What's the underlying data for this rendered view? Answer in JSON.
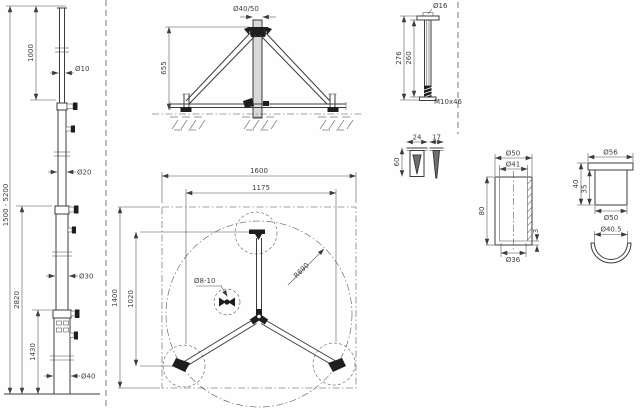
{
  "colors": {
    "line": "#3c3c3c",
    "dark_fill": "#1e1e1e",
    "gray_fill": "#d8d8d8",
    "background": "#fefefe"
  },
  "mast": {
    "dim_overall": "1500 - 5200",
    "dim_top": "1000",
    "dim_mid": "2820",
    "dim_lower": "1430",
    "dia1": "Ø10",
    "dia2": "Ø20",
    "dia3": "Ø30",
    "dia4": "Ø40"
  },
  "elevation": {
    "dia_top": "Ø40/50",
    "height": "655"
  },
  "plan": {
    "w_outer": "1600",
    "w_feet": "1175",
    "h_outer": "1400",
    "h_feet": "1020",
    "radius": "R690",
    "clamp_dia": "Ø8-10"
  },
  "rod": {
    "dia": "Ø16",
    "len_outer": "276",
    "len_inner": "260",
    "thread": "M10x46"
  },
  "wedge": {
    "front_w": "24",
    "side_w": "17",
    "height": "60"
  },
  "sleeve": {
    "outer_dia": "Ø50",
    "inner_dia": "Ø41",
    "height": "80",
    "bottom_dia": "Ø36",
    "lip": "3"
  },
  "cap": {
    "flange_dia": "Ø56",
    "height_total": "40",
    "height_body": "35",
    "body_dia": "Ø50"
  },
  "shell": {
    "dia": "Ø40.5"
  }
}
